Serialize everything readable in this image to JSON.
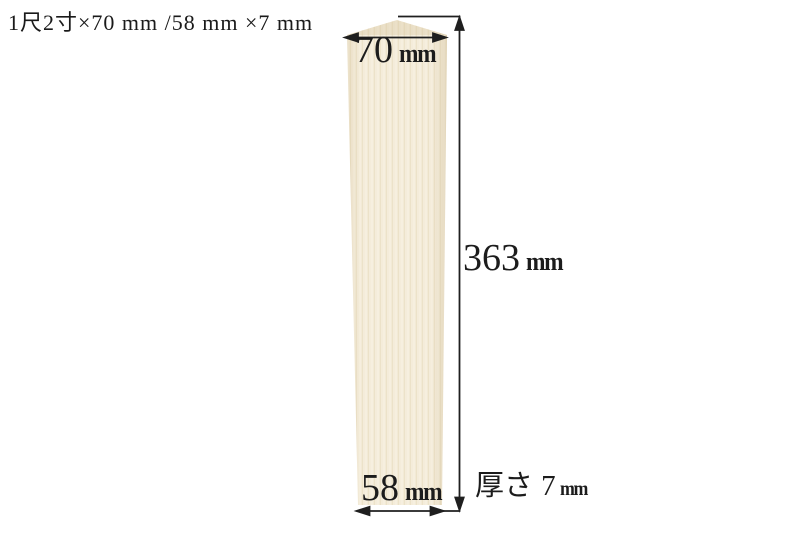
{
  "title": "1尺2寸×70 mm /58 mm ×7 mm",
  "board": {
    "description_color_base": "#f2ead6",
    "description_color_grain": "#ece2c9"
  },
  "dimensions": {
    "top_width": {
      "value": "70",
      "unit": "mm"
    },
    "height": {
      "value": "363",
      "unit": "mm"
    },
    "bottom_width": {
      "value": "58",
      "unit": "mm"
    },
    "thickness": {
      "prefix": "厚さ",
      "value": "7",
      "unit": "mm"
    }
  },
  "colors": {
    "background": "#ffffff",
    "line": "#1f1f1f",
    "text": "#1c1c1c"
  }
}
